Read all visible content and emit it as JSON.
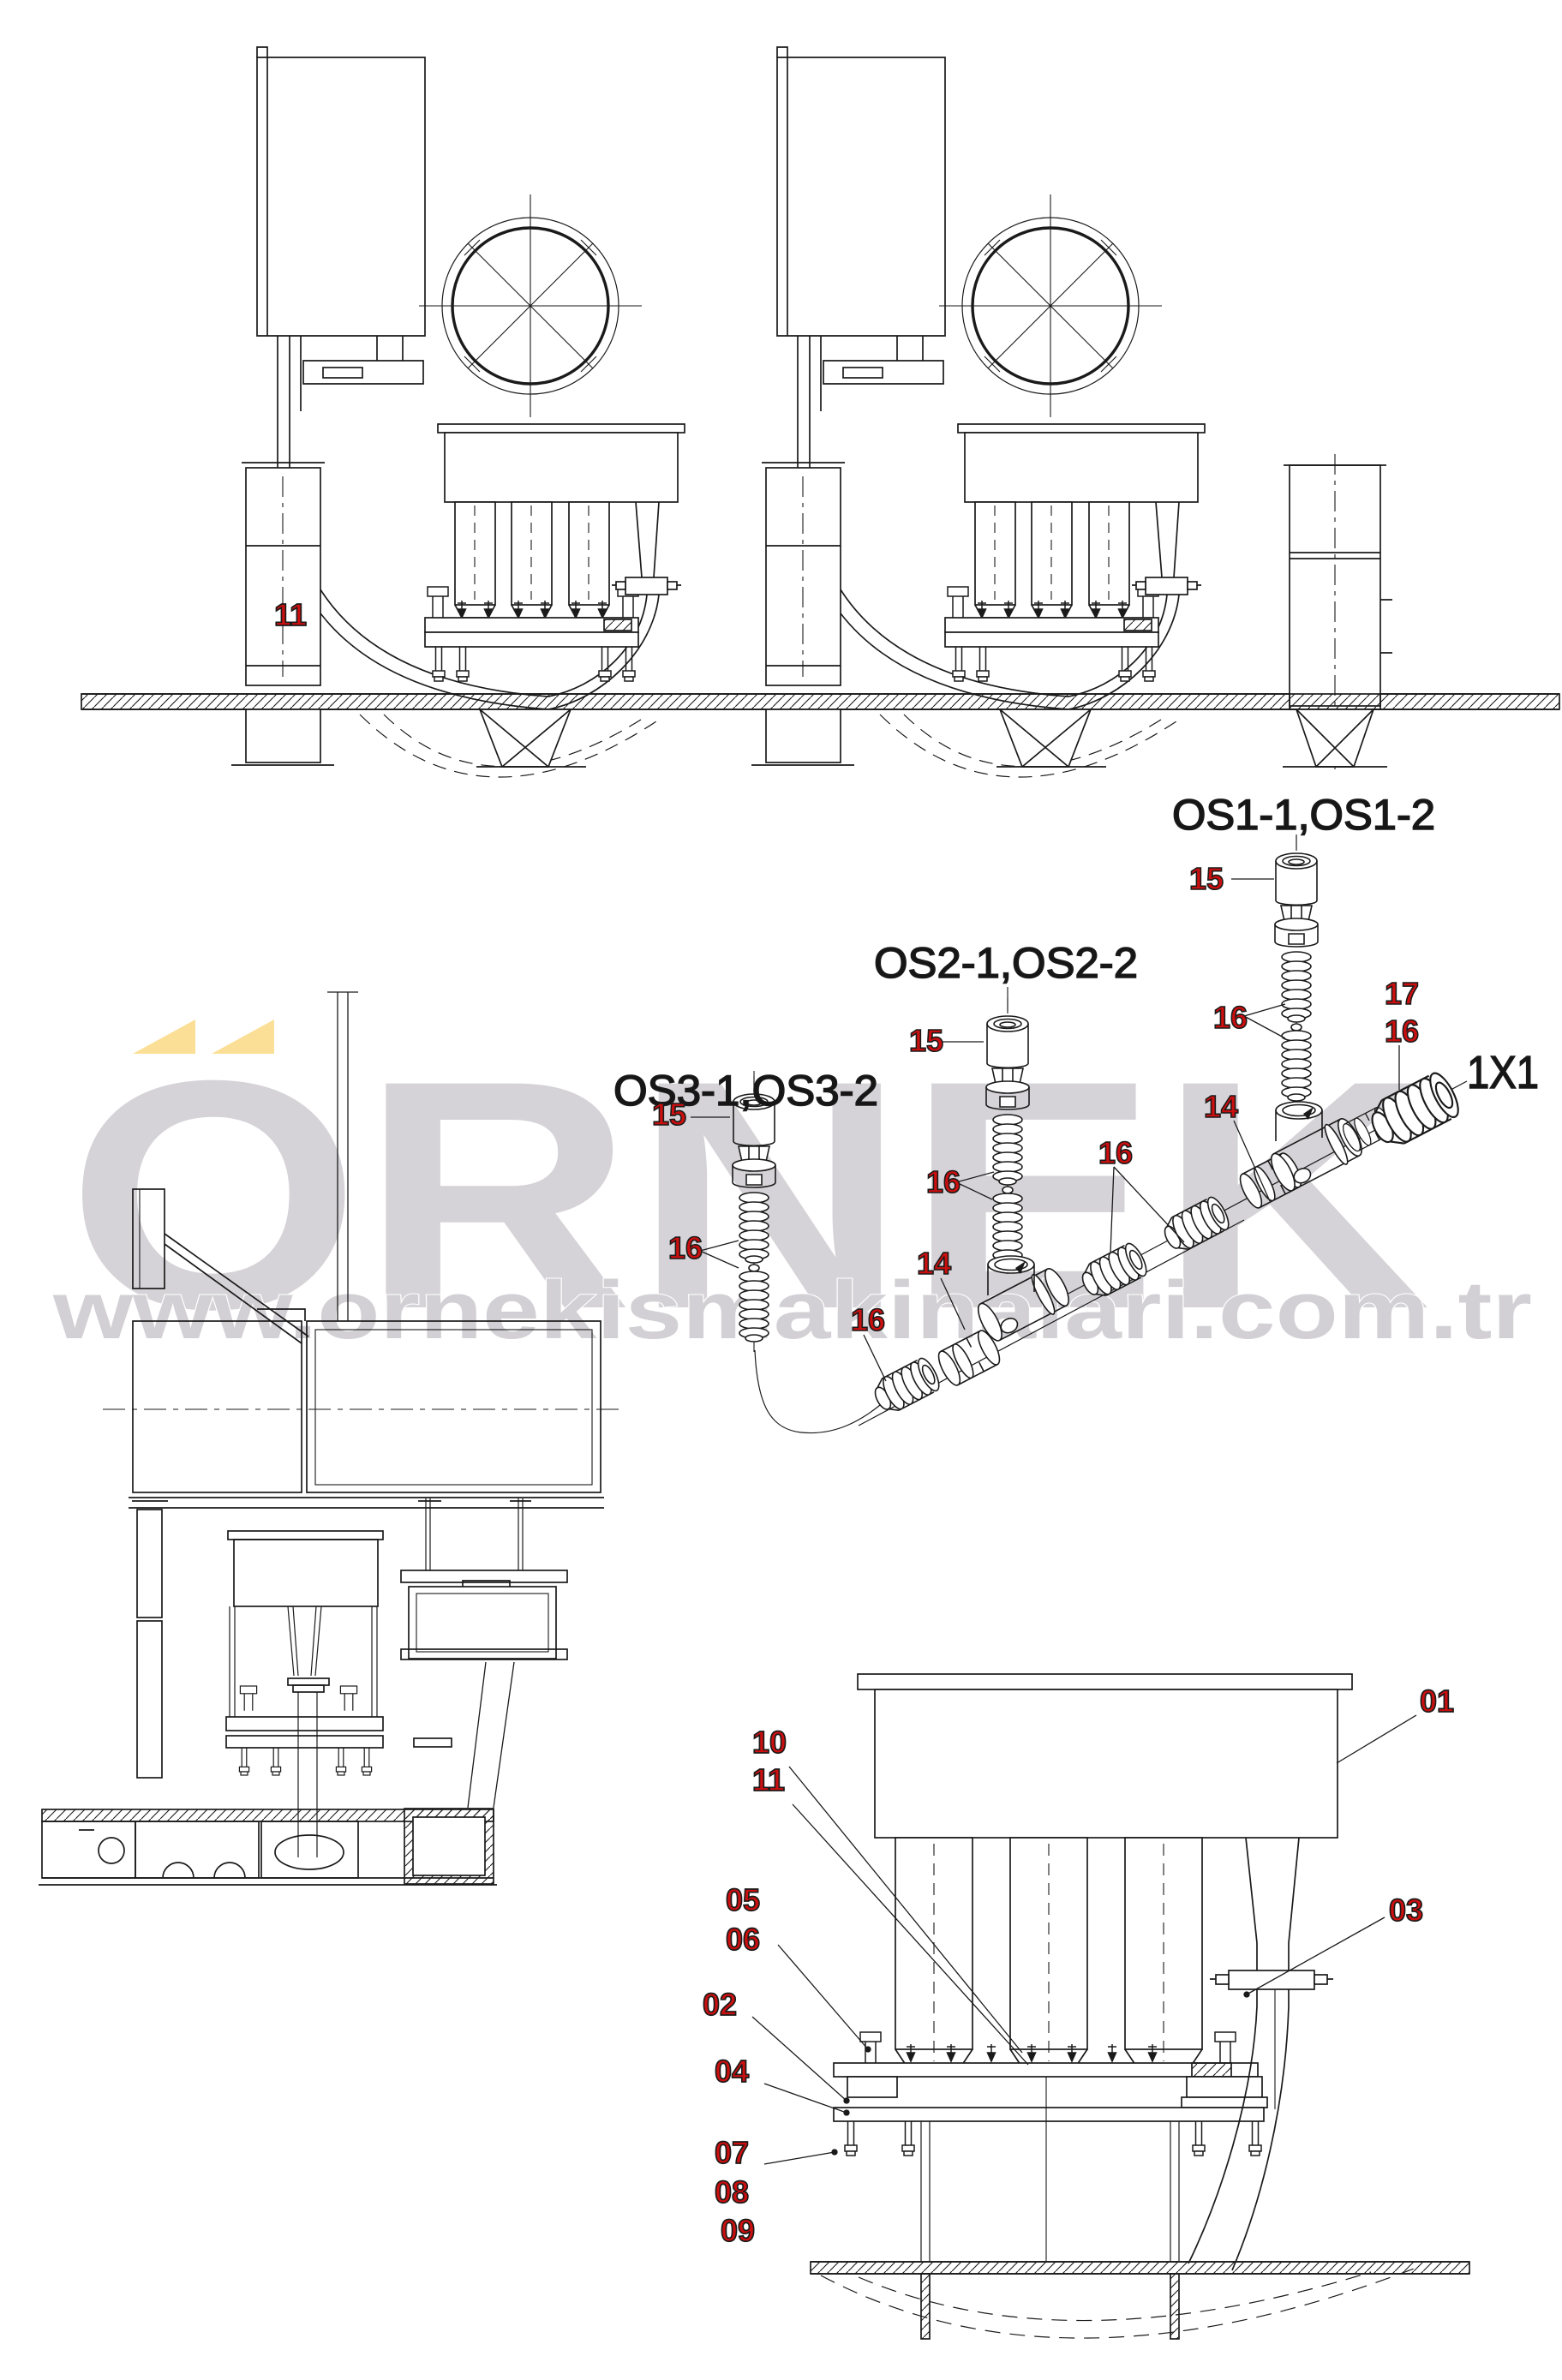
{
  "colors": {
    "line": "#1a1a1a",
    "callout_red": "#cc0f0f",
    "watermark_gray": "#d5d3d7",
    "accent_yellow": "#fbdf97",
    "background": "#ffffff"
  },
  "watermark": {
    "brand": "ÖRNEK",
    "brand_base": "ORNEK",
    "url": "www.ornekismakinalari.com.tr"
  },
  "machine_side_view": {
    "callout_hose": "11"
  },
  "exploded_view": {
    "size_label": "1X1",
    "os1": {
      "title": "OS1-1,OS1-2",
      "callouts": {
        "fitting": "15",
        "springs": "16",
        "nipple": "17",
        "plug": "16",
        "tee": "14"
      }
    },
    "os2": {
      "title": "OS2-1,OS2-2",
      "callouts": {
        "fitting": "15",
        "springs": "16",
        "plugs": "16",
        "tee": "14"
      }
    },
    "os3": {
      "title": "OS3-1,OS3-2",
      "callouts": {
        "fitting": "15",
        "springs": "16",
        "plug": "16"
      }
    }
  },
  "detail_view": {
    "callouts": [
      "01",
      "02",
      "03",
      "04",
      "05",
      "06",
      "07",
      "08",
      "09",
      "10",
      "11"
    ]
  }
}
